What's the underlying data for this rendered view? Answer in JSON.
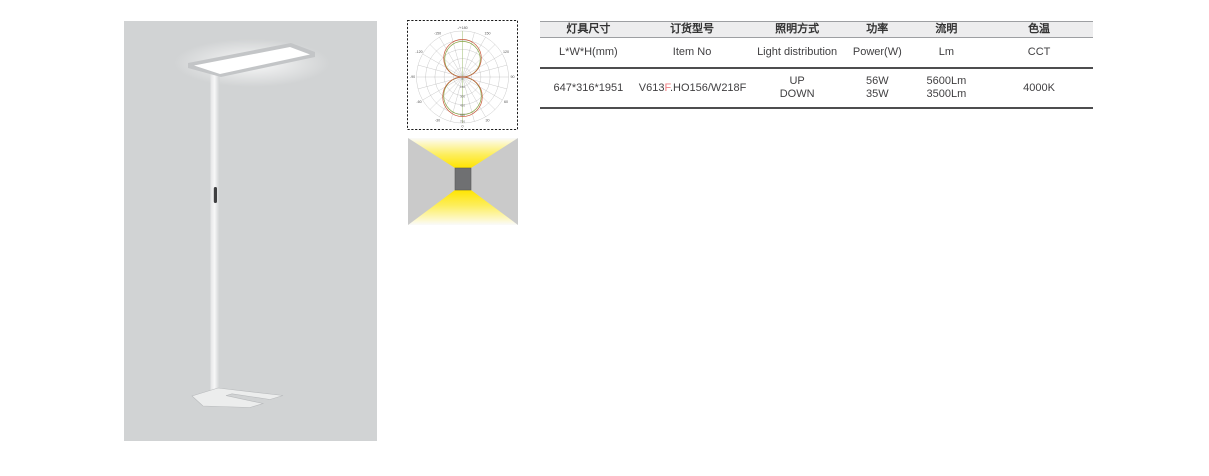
{
  "product": {
    "image_label": "floor-standing-luminaire-photo"
  },
  "photometry": {
    "angle_labels": [
      "-/+180",
      "-150",
      "150",
      "-120",
      "120",
      "-90",
      "90",
      "-60",
      "60",
      "-30",
      "30",
      "0"
    ],
    "radial_labels": [
      "0",
      "150",
      "300",
      "450",
      "600",
      "750"
    ]
  },
  "light_direction_icon": {
    "meaning": "UP and DOWN light emission"
  },
  "table": {
    "headers_zh": [
      "灯具尺寸",
      "订货型号",
      "照明方式",
      "功率",
      "流明",
      "色温"
    ],
    "headers_en": [
      "L*W*H(mm)",
      "Item No",
      "Light distribution",
      "Power(W)",
      "Lm",
      "CCT"
    ],
    "row": {
      "size": "647*316*1951",
      "item_no_prefix": "V613",
      "item_no_highlight": "F",
      "item_no_suffix": ".HO156/W218F",
      "light_distribution_line1": "UP",
      "light_distribution_line2": "DOWN",
      "power_line1": "56W",
      "power_line2": "35W",
      "lumens_line1": "5600Lm",
      "lumens_line2": "3500Lm",
      "cct": "4000K"
    }
  },
  "colors": {
    "highlight_red": "#ee7d80",
    "panel_gray": "#d1d3d4",
    "icon_background_gray": "#cacaca",
    "light_yellow": "#ffe400",
    "polar_curve_red": "#c85a3c",
    "polar_curve_green": "#85a342",
    "table_heavy_line": "#4d4d4f",
    "table_light_line": "#9d9fa2",
    "header_fill": "#ededee"
  }
}
